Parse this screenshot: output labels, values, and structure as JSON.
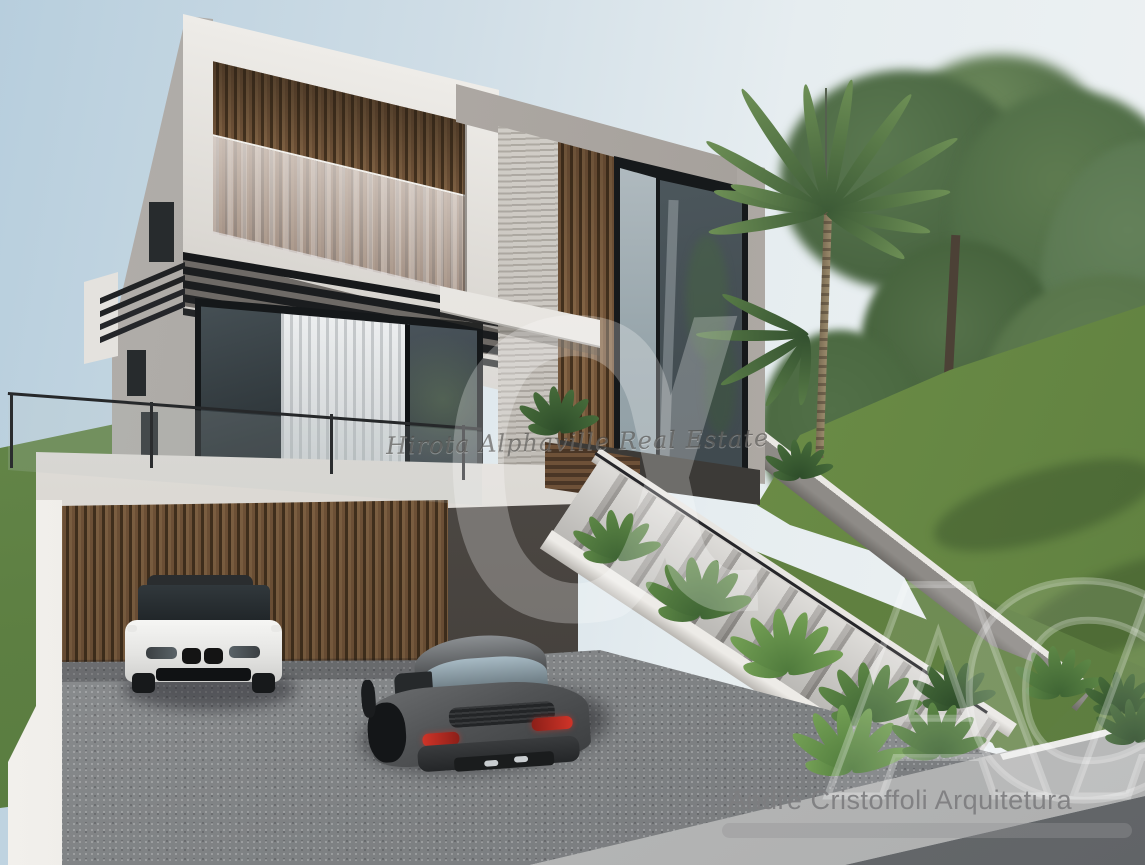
{
  "meta": {
    "type": "architectural-rendering",
    "subject": "Modern two-story house with wood-slat garage, concrete exterior staircase, palm tree, lawn and two parked cars"
  },
  "watermarks": {
    "realtor_script": "Hirota Alphaville Real Estate",
    "logo_glyph": "α",
    "monogram": "ACA",
    "architect_credit": "André Cristoffoli Arquitetura"
  },
  "palette": {
    "sky_left": "#b7cedd",
    "sky_right": "#eef2f3",
    "concrete_white": "#eceae6",
    "concrete_gray": "#a9a49f",
    "wood": "#7a5a3d",
    "glass_dark": "#39424 6",
    "grass": "#6b8c46",
    "driveway": "#8f9193",
    "taillight_red": "#c22a26"
  }
}
